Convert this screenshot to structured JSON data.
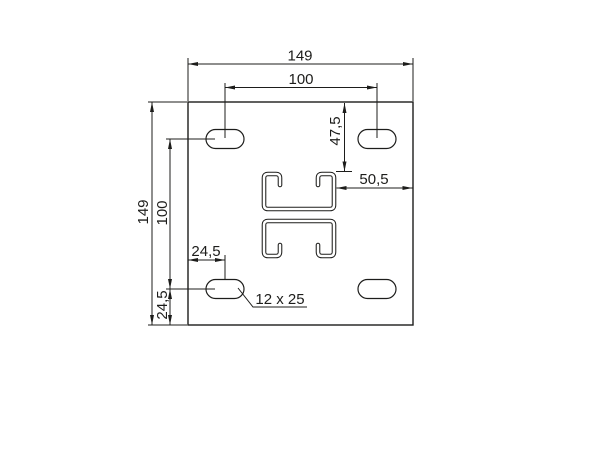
{
  "colors": {
    "ink": "#1d1d1b",
    "paper": "#ffffff"
  },
  "drawing": {
    "type": "technical-dimension-drawing",
    "part": "square mounting plate with four slotted holes and double strut-channel cutout"
  },
  "labels": {
    "total_width": "149",
    "slot_spacing_horizontal": "100",
    "total_height": "149",
    "slot_spacing_vertical": "100",
    "profile_offset_from_top": "47,5",
    "profile_offset_from_right": "50,5",
    "slot_offset_from_left": "24,5",
    "slot_offset_from_bottom": "24,5",
    "slot_size_callout": "12 x 25"
  }
}
